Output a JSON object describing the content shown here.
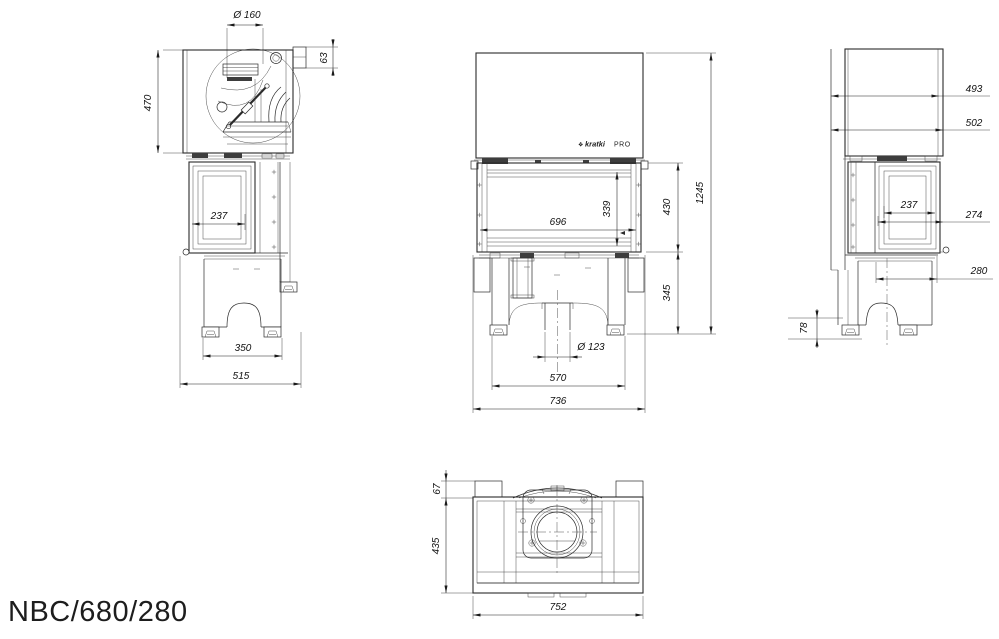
{
  "page": {
    "background": "#ffffff",
    "line_color": "#2b2b2b",
    "dim_text_color": "#111111"
  },
  "title": "NBC/680/280",
  "brand": {
    "mark": "❖",
    "name": "kratki",
    "suffix": "PRO"
  },
  "views": {
    "side_left": {
      "dims": {
        "flue_diameter": "Ø 160",
        "collar_offset": "63",
        "hood_height": "470",
        "glass_depth": "237",
        "foot_spacing": "350",
        "overall_depth": "515"
      }
    },
    "front": {
      "dims": {
        "glass_width": "696",
        "glass_height": "339",
        "firebox_height": "430",
        "overall_height": "1245",
        "base_height": "345",
        "air_inlet_diameter": "Ø 123",
        "leg_spacing": "570",
        "overall_width": "736"
      }
    },
    "side_right": {
      "dims": {
        "top_depth": "493",
        "hood_depth": "502",
        "glass_depth": "237",
        "door_depth": "274",
        "base_depth": "280",
        "foot_height": "78"
      }
    },
    "top": {
      "dims": {
        "bracket_offset": "67",
        "overall_depth": "435",
        "overall_width": "752"
      }
    }
  }
}
